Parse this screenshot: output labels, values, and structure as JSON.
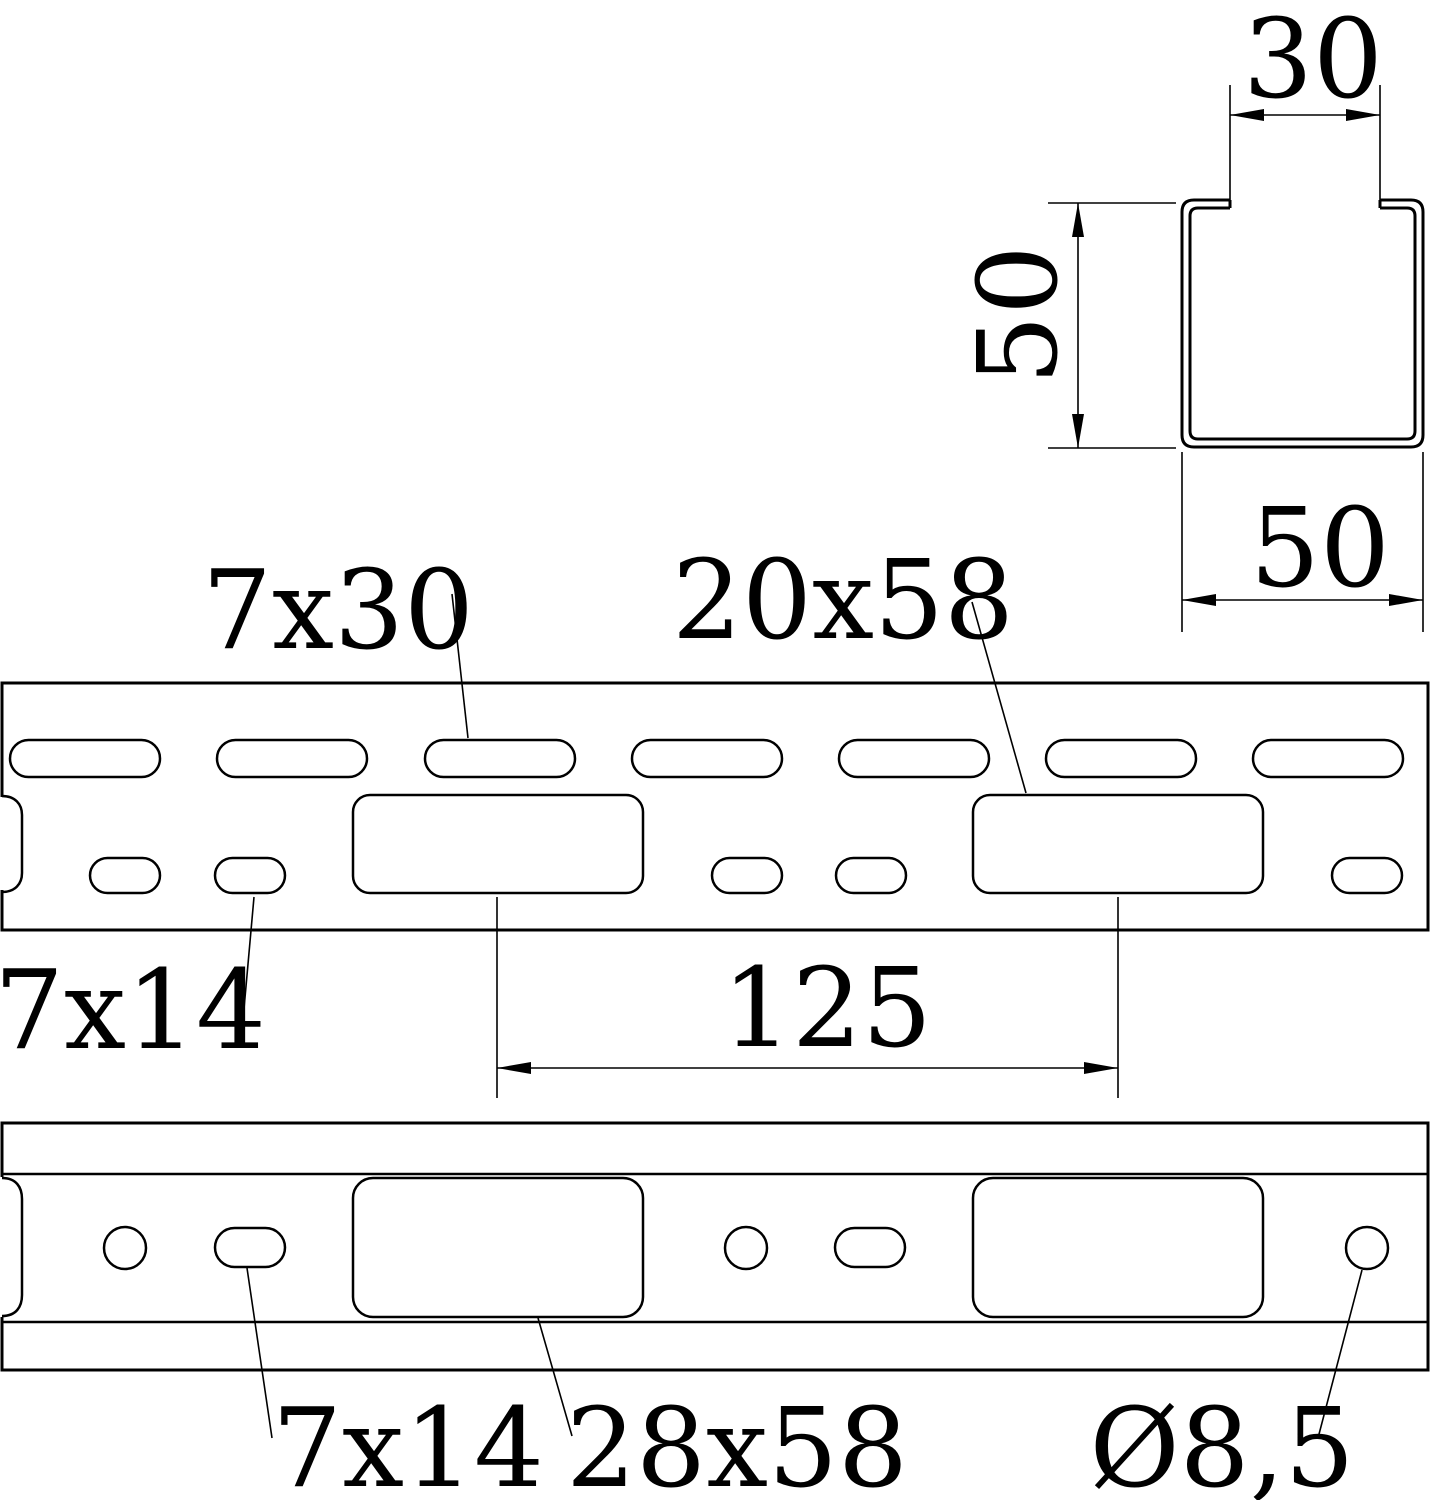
{
  "title": "Perforated mounting rail – technical drawing",
  "colors": {
    "background": "#ffffff",
    "line": "#000000"
  },
  "cross_section": {
    "dim_slot_width": "30",
    "dim_height": "50",
    "dim_width": "50"
  },
  "plan_view": {
    "top_slot_label": "7x30",
    "large_slot_label": "20x58",
    "small_slot_label": "7x14",
    "pitch_dim": "125"
  },
  "side_view": {
    "small_slot_label": "7x14",
    "large_slot_label": "28x58",
    "hole_dia_label": "Ø8,5"
  }
}
